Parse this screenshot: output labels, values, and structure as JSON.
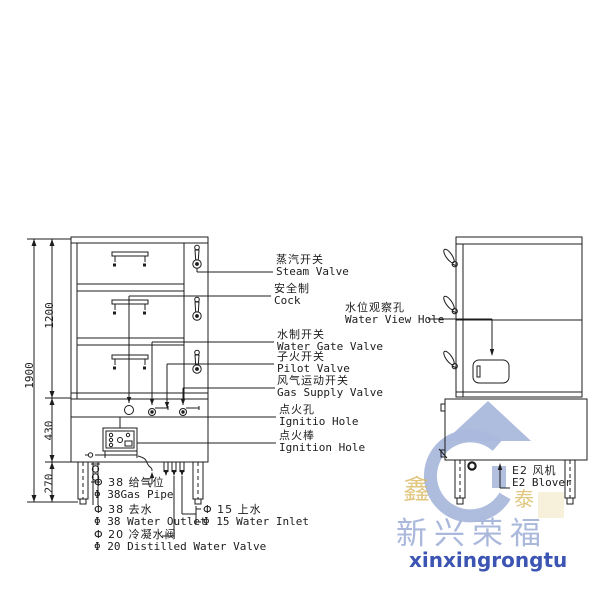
{
  "diagram_title": "steam-cabinet-technical-drawing",
  "dimensions": {
    "total_height": "1900",
    "cabinet_height": "1200",
    "base_height": "430",
    "leg_height": "270"
  },
  "labels": {
    "steam_valve": {
      "cn": "蒸汽开关",
      "en": "Steam Valve"
    },
    "cock": {
      "cn": "安全制",
      "en": "Cock"
    },
    "water_view_hole": {
      "cn": "水位观察孔",
      "en": "Water View Hole"
    },
    "water_gate_valve": {
      "cn": "水制开关",
      "en": "Water Gate Valve"
    },
    "pilot_valve": {
      "cn": "子火开关",
      "en": "Pilot Valve"
    },
    "gas_supply_valve": {
      "cn": "风气运动开关",
      "en": "Gas Supply Valve"
    },
    "ignitio_hole": {
      "cn": "点火孔",
      "en": "Ignitio Hole"
    },
    "ignition_rod": {
      "cn": "点火棒",
      "en": "Ignition Hole"
    },
    "gas_pipe": {
      "cn": "Φ 38 给气位",
      "en": "Φ 38Gas Pipe"
    },
    "water_outlet": {
      "cn": "Φ 38 去水",
      "en": "Φ 38 Water Outlet"
    },
    "distilled_water": {
      "cn": "Φ 20 冷凝水阀",
      "en": "Φ 20 Distilled Water Valve"
    },
    "water_inlet": {
      "cn": "Φ 15 上水",
      "en": "Φ 15 Water Inlet"
    },
    "blower": {
      "cn": "E2 风机",
      "en": "E2 Blover"
    }
  },
  "watermark": {
    "brand_cn": "新兴荣福",
    "brand_en": "xinxingrongtu",
    "seal_left": "鑫",
    "seal_right": "泰",
    "light_blue": "#aab8dc",
    "text_blue": "#3d55b2",
    "gold": "#d9b95e"
  },
  "line_color": "#1c1c1c"
}
